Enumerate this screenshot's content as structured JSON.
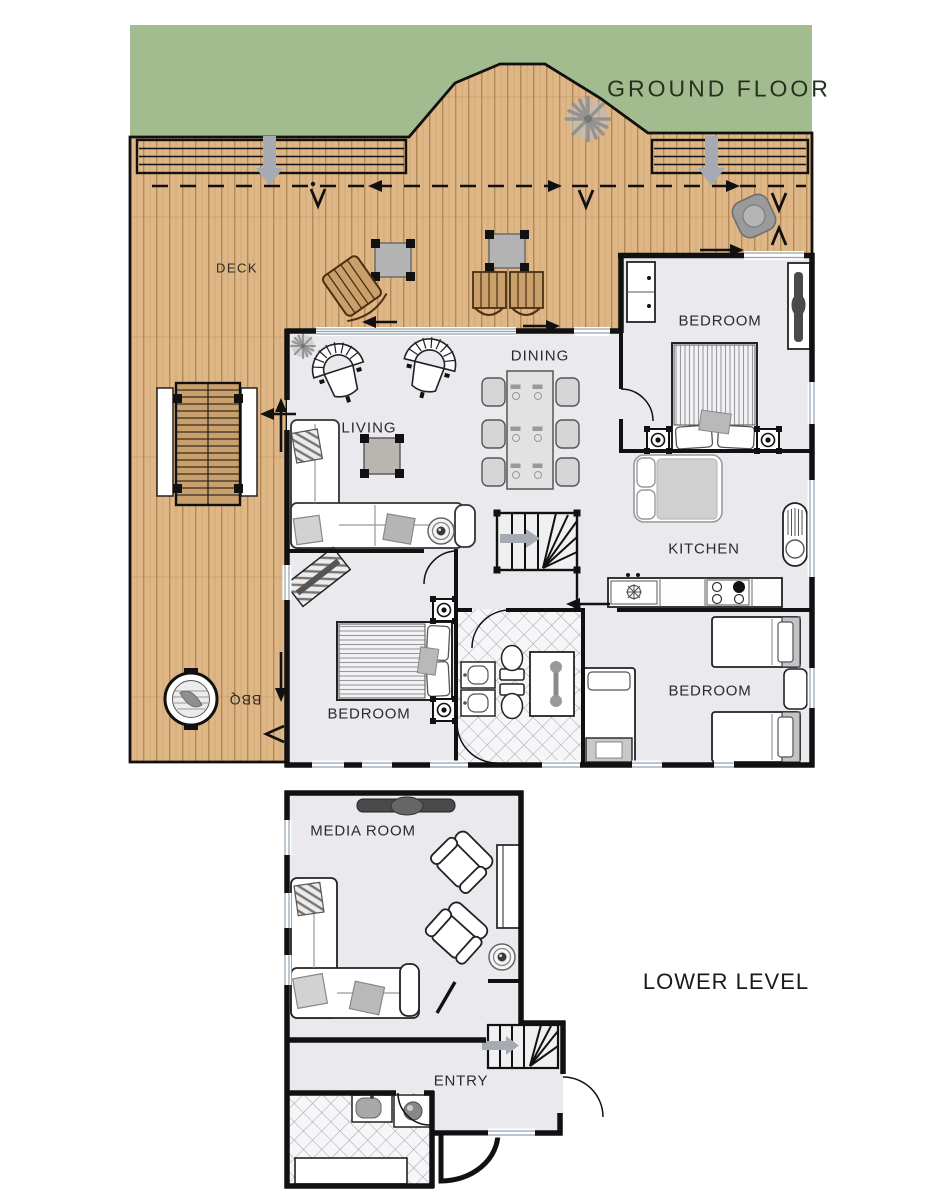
{
  "floors": [
    {
      "id": "ground",
      "title": "GROUND FLOOR"
    },
    {
      "id": "lower",
      "title": "LOWER LEVEL"
    }
  ],
  "labels": {
    "ground_floor": "GROUND FLOOR",
    "lower_level": "LOWER LEVEL",
    "deck": "DECK",
    "living": "LIVING",
    "dining": "DINING",
    "kitchen": "KITCHEN",
    "bedroom_master": "BEDROOM",
    "bedroom_left": "BEDROOM",
    "bedroom_right": "BEDROOM",
    "media_room": "MEDIA ROOM",
    "entry": "ENTRY",
    "bbq": "BBQ"
  },
  "colors": {
    "grass": "#a2bc90",
    "deck_wood": "#dfb685",
    "interior_floor": "#eaeaee",
    "wall": "#111111",
    "furniture_gray": "#b5b5b5",
    "arrow_gray": "#a6abb3",
    "window_line": "#8fa3b5"
  }
}
